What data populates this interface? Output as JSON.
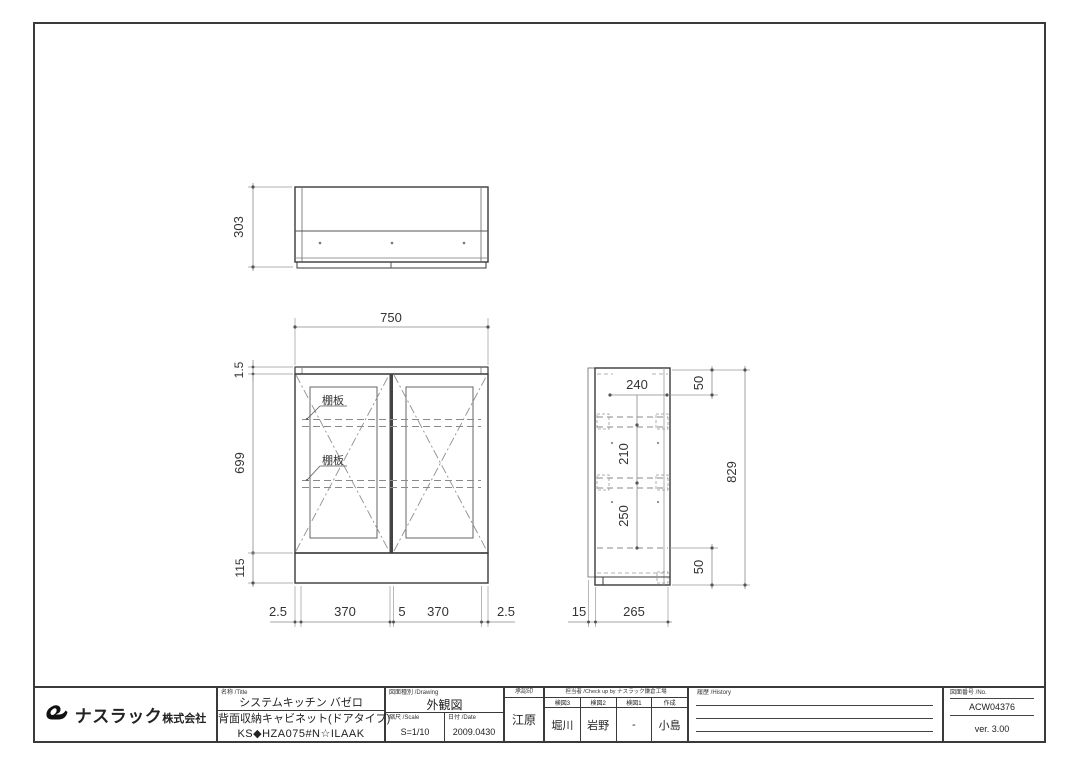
{
  "page": {
    "background": "#ffffff",
    "line_color": "#3a3a3a",
    "light_line_color": "#8a8a8a",
    "accent": "#111111"
  },
  "icons": {
    "logo": "nasluck-swan-logo-icon"
  },
  "views": {
    "top_view": {
      "dims": {
        "depth": "303"
      }
    },
    "front_view": {
      "dims": {
        "width": "750",
        "top_edge": "1.5",
        "body_height": "699",
        "base_height": "115",
        "bottom_row": [
          "2.5",
          "370",
          "5",
          "370",
          "2.5"
        ]
      },
      "labels": {
        "shelf1": "棚板",
        "shelf2": "棚板"
      }
    },
    "side_view": {
      "dims": {
        "inner_depth": "240",
        "top_offset": "50",
        "pitch_upper": "210",
        "pitch_lower": "250",
        "bottom_offset": "50",
        "total_height": "829",
        "bottom_row": [
          "15",
          "265"
        ]
      }
    }
  },
  "title_block": {
    "company_name": "ナスラック",
    "company_suffix": "株式会社",
    "name_label": "名称 /Title",
    "product_line1": "システムキッチン バゼロ",
    "product_line2": "背面収納キャビネット(ドアタイプ)",
    "product_code": "KS◆HZA075#N☆ILAAK",
    "drawing_type_label": "図面種別 /Drawing",
    "drawing_type": "外観図",
    "scale_label": "縮尺 /Scale",
    "scale": "S=1/10",
    "date_label": "日付 /Date",
    "date": "2009.0430",
    "approval_label": "承認印",
    "approval": "江原",
    "checkup_label": "担当者 /Check up by ナスラック鎌倉工場",
    "check_columns": [
      {
        "label": "検図3",
        "value": "堀川"
      },
      {
        "label": "検図2",
        "value": "岩野"
      },
      {
        "label": "検図1",
        "value": "-"
      },
      {
        "label": "作成",
        "value": "小島"
      }
    ],
    "history_label": "履歴 /History",
    "number_label": "図面番号 /No.",
    "drawing_number": "ACW04376",
    "version": "ver. 3.00"
  }
}
